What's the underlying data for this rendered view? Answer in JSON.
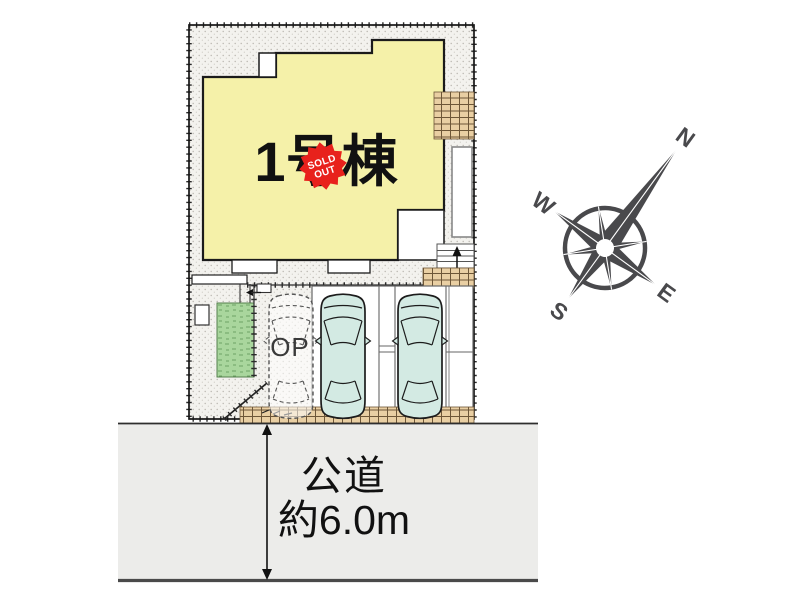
{
  "plan": {
    "building_label": "1号棟",
    "badge": {
      "line1": "SOLD",
      "line2": "OUT"
    },
    "op_label": "OP",
    "colors": {
      "building": "#f5f1a9",
      "badge": "#e8211c",
      "car": "#d3eae3",
      "grass": "#a9d69d",
      "brick": "#e9cfa3",
      "road": "#ececea",
      "compass": "#49494c"
    }
  },
  "road": {
    "name": "公道",
    "width_label": "約6.0m"
  },
  "compass": {
    "north": "N",
    "west": "W",
    "south": "S",
    "east": "E"
  }
}
